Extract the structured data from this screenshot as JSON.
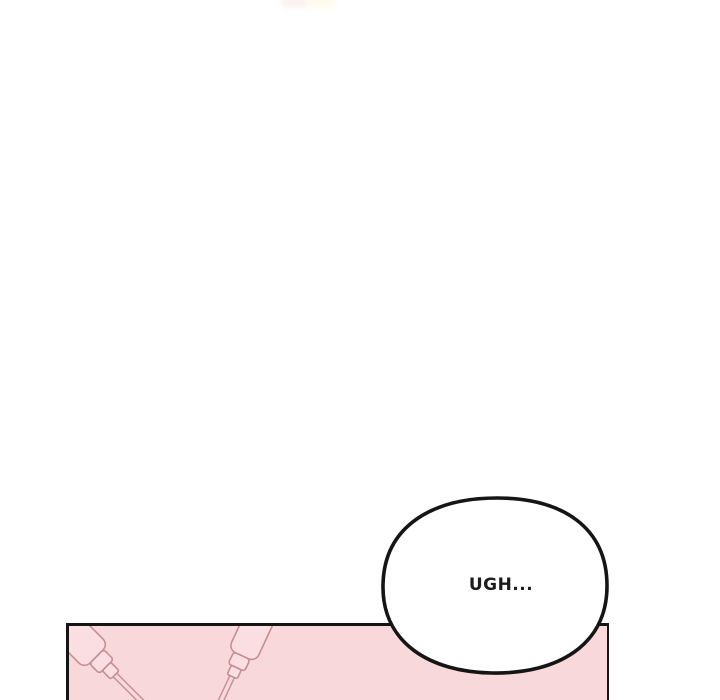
{
  "scene": {
    "kind": "webtoon-comic-panel"
  },
  "speech_bubble": {
    "text": "UGH..."
  },
  "colors": {
    "page_bg": "#ffffff",
    "panel_pink": "#f8d8db",
    "connector_fill": "#fbdee1",
    "cable_outline": "#c48e94",
    "line_black": "#151515",
    "bubble_fill": "#ffffff",
    "text_color": "#1c1c1c",
    "smudge_pink": "#fdeff0",
    "smudge_cream": "#fffaec"
  }
}
